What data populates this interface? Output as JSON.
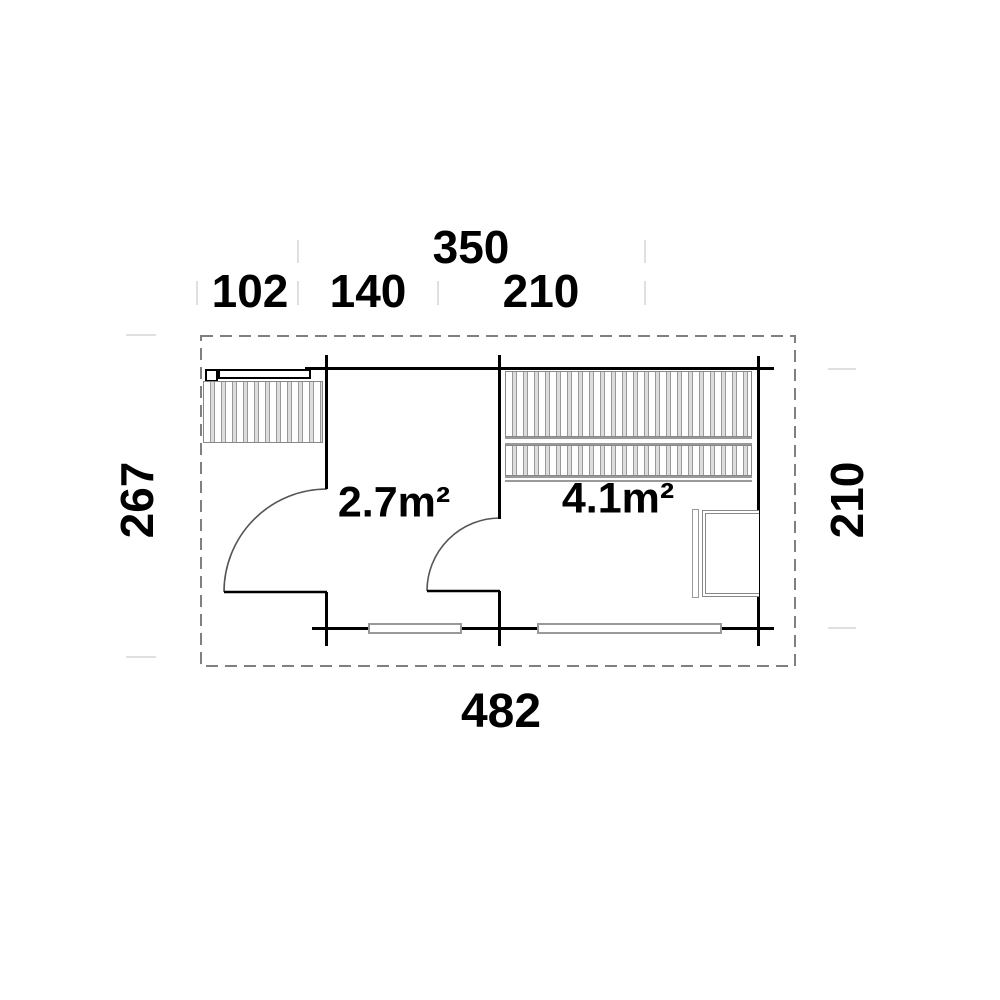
{
  "plan": {
    "type": "floor-plan",
    "dimensions": {
      "top_total": "350",
      "top_segment_1": "102",
      "top_segment_2": "140",
      "top_segment_3": "210",
      "bottom_total": "482",
      "left_total": "267",
      "right_total": "210"
    },
    "rooms": {
      "room1_area": "2.7m²",
      "room2_area": "4.1m²"
    },
    "colors": {
      "wall": "#000000",
      "door_arc": "#555555",
      "hatch_line": "#999999",
      "roof_dashed_outline": "#808080",
      "dimension_tick": "#e0e0e0",
      "background": "#ffffff"
    }
  }
}
